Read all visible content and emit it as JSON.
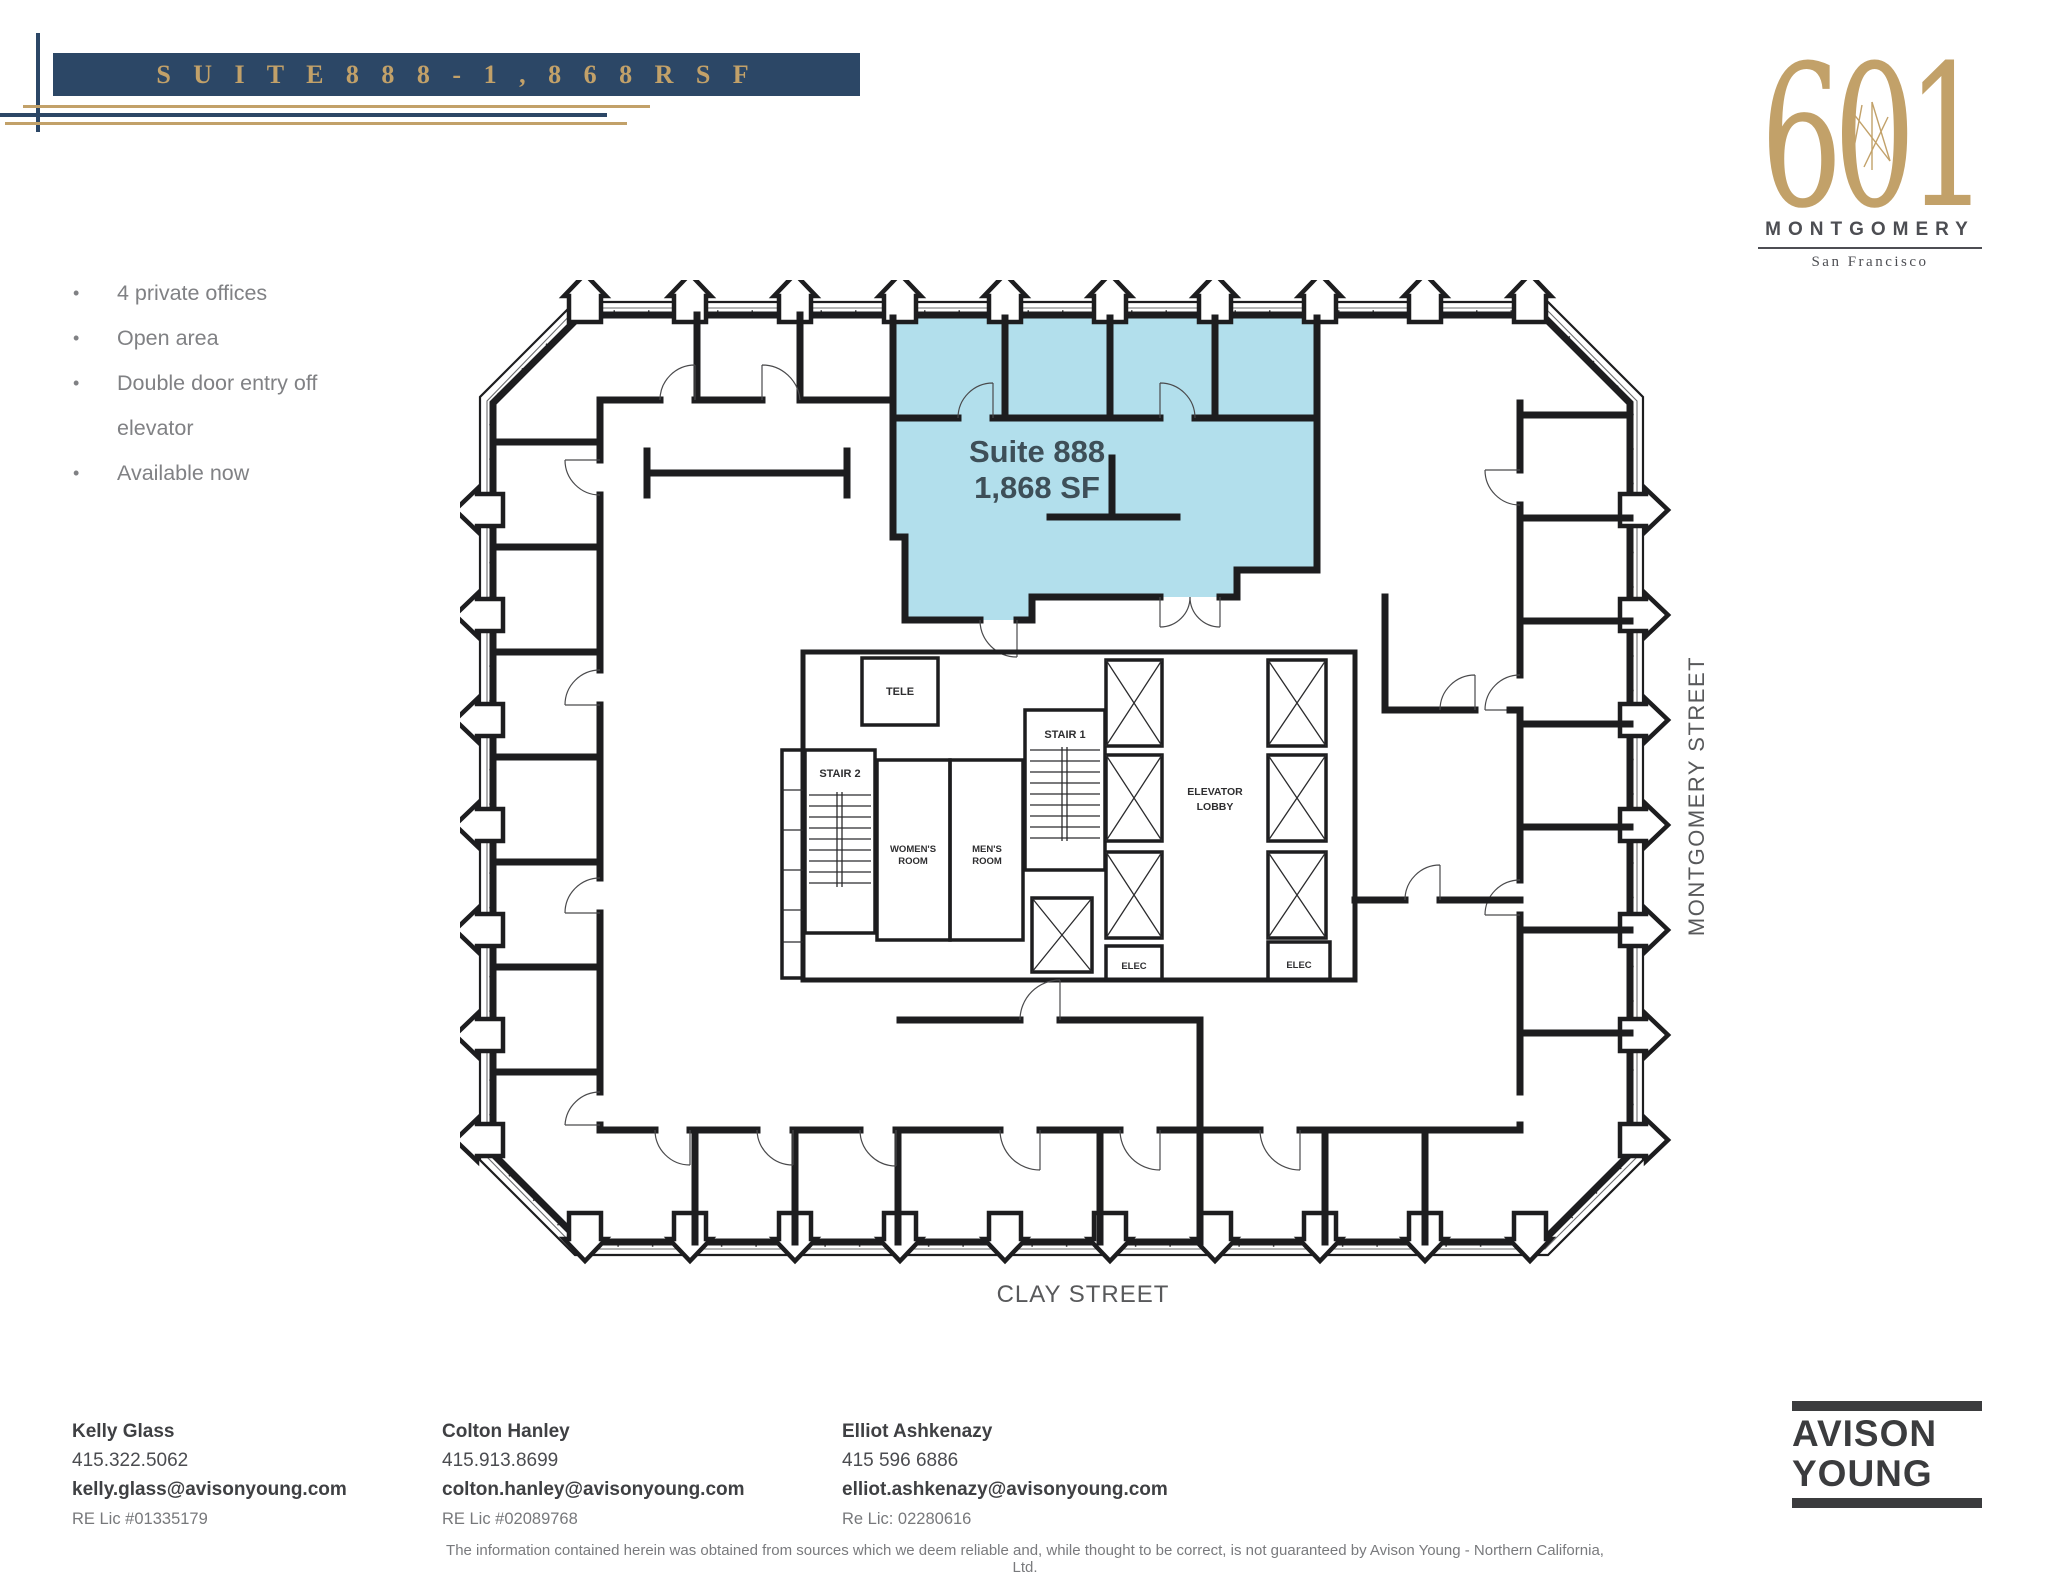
{
  "header": {
    "banner_title": "S U I T E  8 8 8  -  1 , 8 6 8  R S F"
  },
  "building_logo": {
    "number": "601",
    "name": "MONTGOMERY",
    "city": "San Francisco"
  },
  "highlights": {
    "items": [
      "4 private offices",
      "Open area",
      "Double door entry off elevator",
      "Available now"
    ]
  },
  "floor_plan": {
    "suite": {
      "name": "Suite 888",
      "area": "1,868 SF"
    },
    "labels": {
      "tele": "TELE",
      "stair2": "STAIR 2",
      "stair1": "STAIR 1",
      "womens_1": "WOMEN'S",
      "womens_2": "ROOM",
      "mens_1": "MEN'S",
      "mens_2": "ROOM",
      "lobby_1": "ELEVATOR",
      "lobby_2": "LOBBY",
      "elec_left": "ELEC",
      "elec_right": "ELEC"
    },
    "streets": {
      "right": "MONTGOMERY STREET",
      "bottom": "CLAY STREET"
    }
  },
  "contacts": [
    {
      "name": "Kelly Glass",
      "phone": "415.322.5062",
      "email": "kelly.glass@avisonyoung.com",
      "license": "RE Lic #01335179"
    },
    {
      "name": "Colton Hanley",
      "phone": "415.913.8699",
      "email": "colton.hanley@avisonyoung.com",
      "license": "RE Lic #02089768"
    },
    {
      "name": "Elliot Ashkenazy",
      "phone": "415 596 6886",
      "email": "elliot.ashkenazy@avisonyoung.com",
      "license": "Re Lic: 02280616"
    }
  ],
  "broker_logo": {
    "line1": "AVISON",
    "line2": "YOUNG"
  },
  "disclaimer": "The information contained herein was obtained from sources which we deem reliable and, while thought to be correct, is not guaranteed by Avison Young - Northern California, Ltd.",
  "colors": {
    "navy": "#2c4766",
    "gold": "#c2a169",
    "suite_fill": "#b2dfec",
    "suite_text": "#3e4f58",
    "bullet_gray": "#808184",
    "street_gray": "#58595b",
    "contact_dark": "#3f4043",
    "plan_line": "#1d1d1f"
  }
}
